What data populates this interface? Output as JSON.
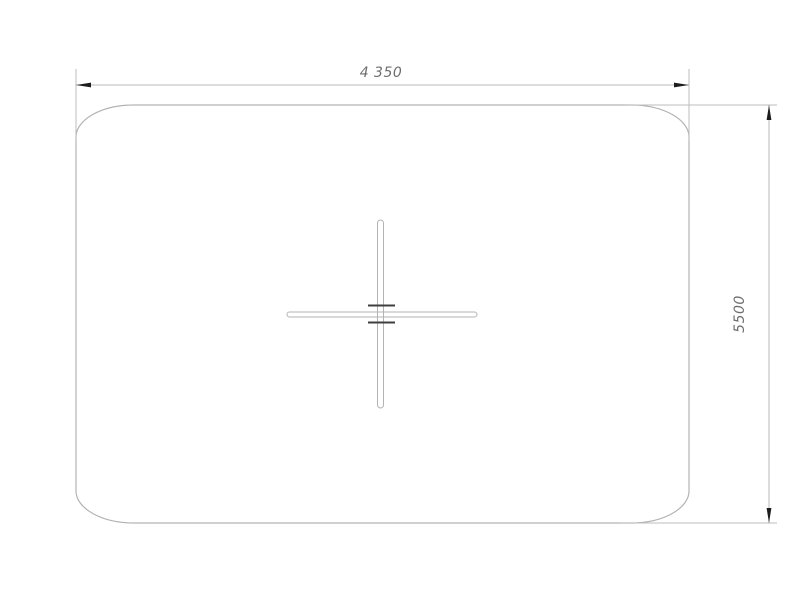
{
  "canvas": {
    "background": "#ffffff"
  },
  "colors": {
    "background": "#ffffff",
    "outline": "#b2b3b2",
    "ext_line": "#bdbdbd",
    "dim_line": "#b7b8b7",
    "arrow": "#1d1d1d",
    "tick": "#3f3f3f",
    "dim_text": "#6e6e6e"
  },
  "dimensions": {
    "width": {
      "label": "4 350"
    },
    "height": {
      "label": "5500"
    }
  }
}
